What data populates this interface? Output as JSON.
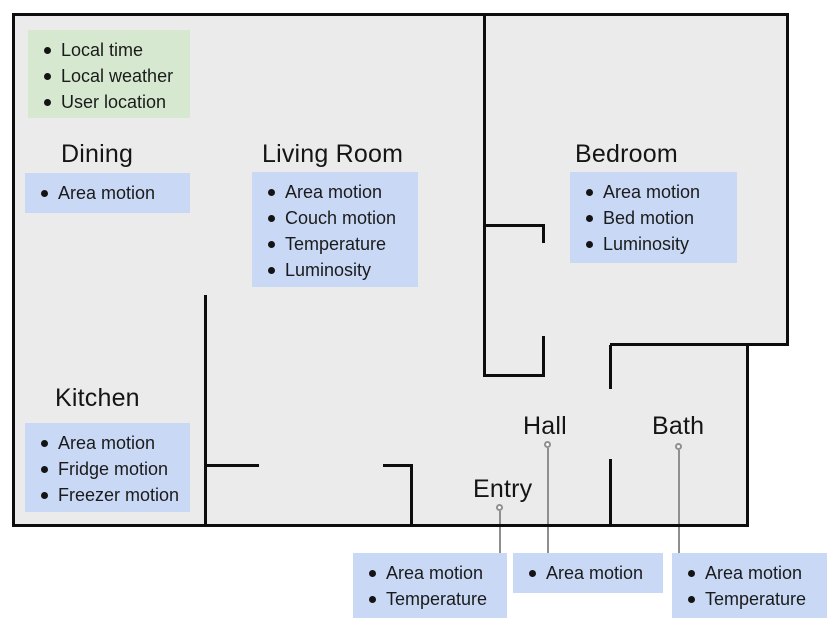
{
  "diagram_title": "Smart home floor plan with sensors",
  "global_context": {
    "items": [
      "Local time",
      "Local weather",
      "User location"
    ]
  },
  "rooms": {
    "dining": {
      "title": "Dining",
      "items": [
        "Area motion"
      ]
    },
    "living": {
      "title": "Living Room",
      "items": [
        "Area motion",
        "Couch motion",
        "Temperature",
        "Luminosity"
      ]
    },
    "bedroom": {
      "title": "Bedroom",
      "items": [
        "Area motion",
        "Bed motion",
        "Luminosity"
      ]
    },
    "kitchen": {
      "title": "Kitchen",
      "items": [
        "Area motion",
        "Fridge motion",
        "Freezer motion"
      ]
    },
    "entry": {
      "title": "Entry",
      "items": [
        "Area motion",
        "Temperature"
      ]
    },
    "hall": {
      "title": "Hall",
      "items": [
        "Area motion"
      ]
    },
    "bath": {
      "title": "Bath",
      "items": [
        "Area motion",
        "Temperature"
      ]
    }
  },
  "colors": {
    "floor": "#ebebeb",
    "wall": "#0d0d0d",
    "sensor_box": "#c8d8f5",
    "global_box": "#d6e8d0",
    "leader_line": "#8f8f8f",
    "text": "#1b1b1b"
  }
}
